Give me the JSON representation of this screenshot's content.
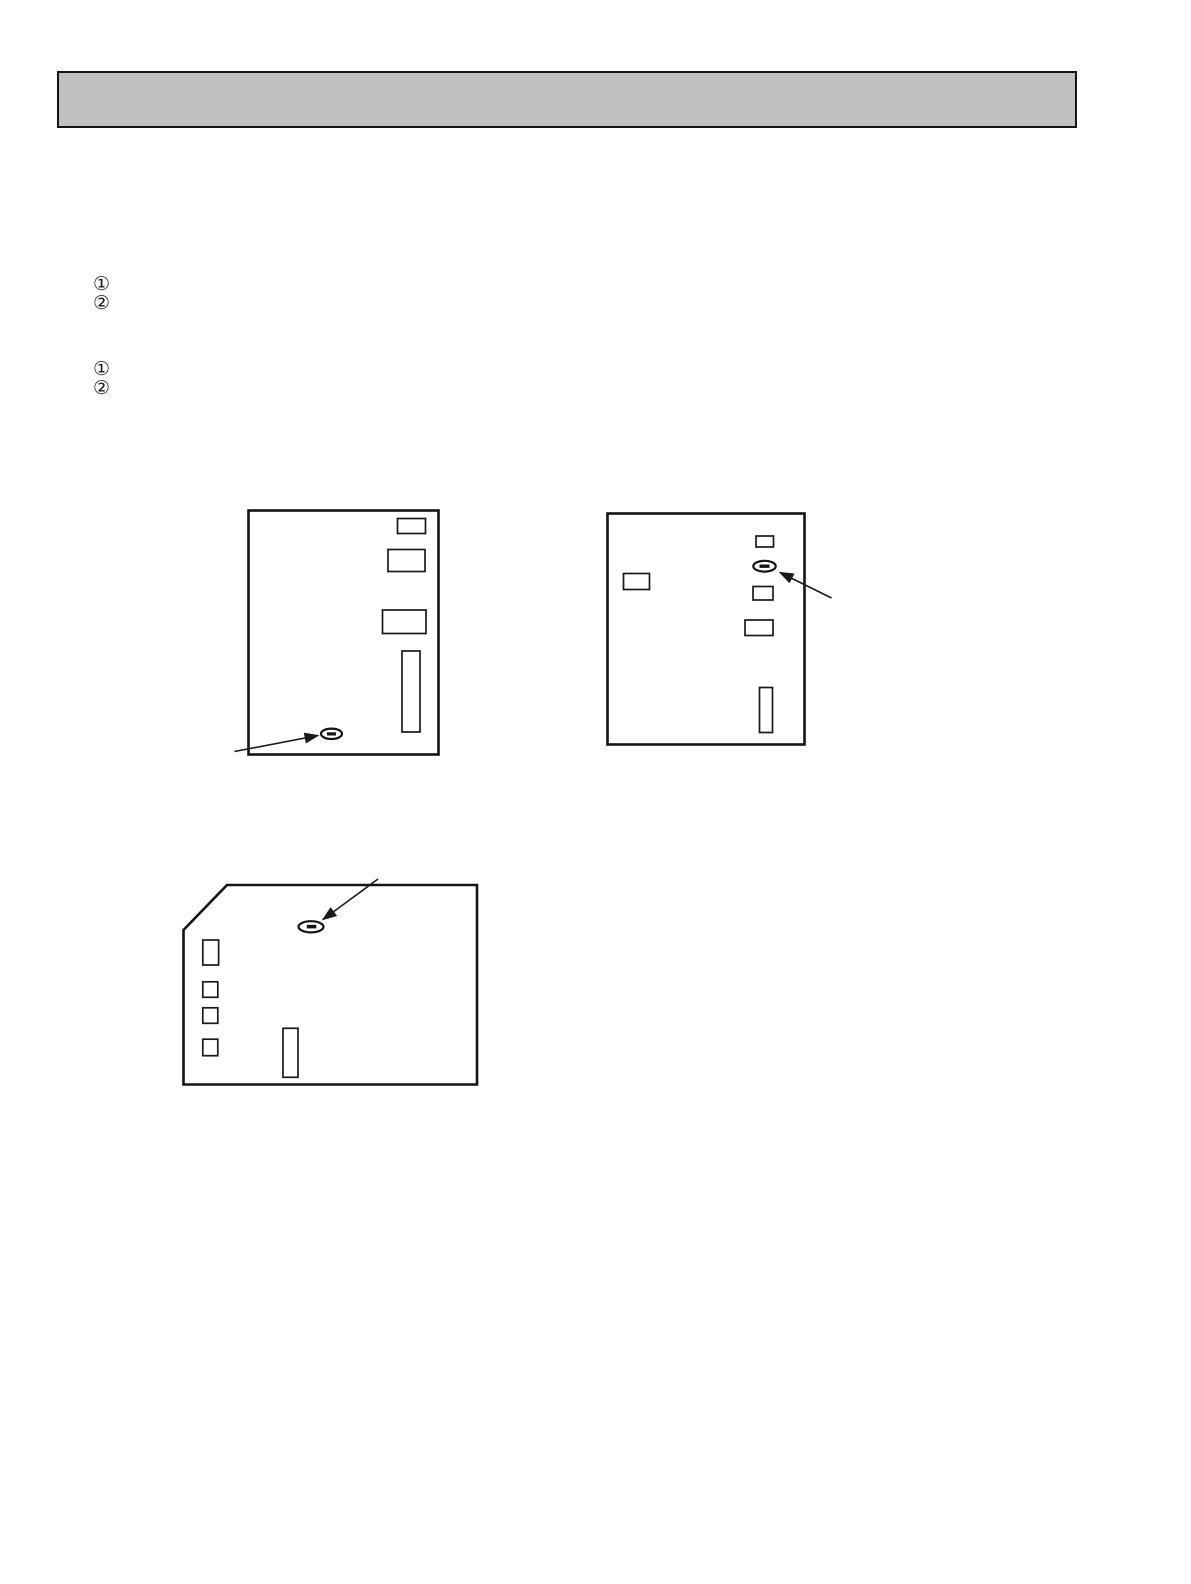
{
  "document": {
    "background_color": "#ffffff",
    "ink_color": "#141414"
  },
  "header_bar": {
    "fill_color": "#c0c0c0",
    "text": ""
  },
  "step_lists": {
    "first": {
      "markers": [
        "①",
        "②"
      ]
    },
    "second": {
      "markers": [
        "①",
        "②"
      ]
    }
  }
}
